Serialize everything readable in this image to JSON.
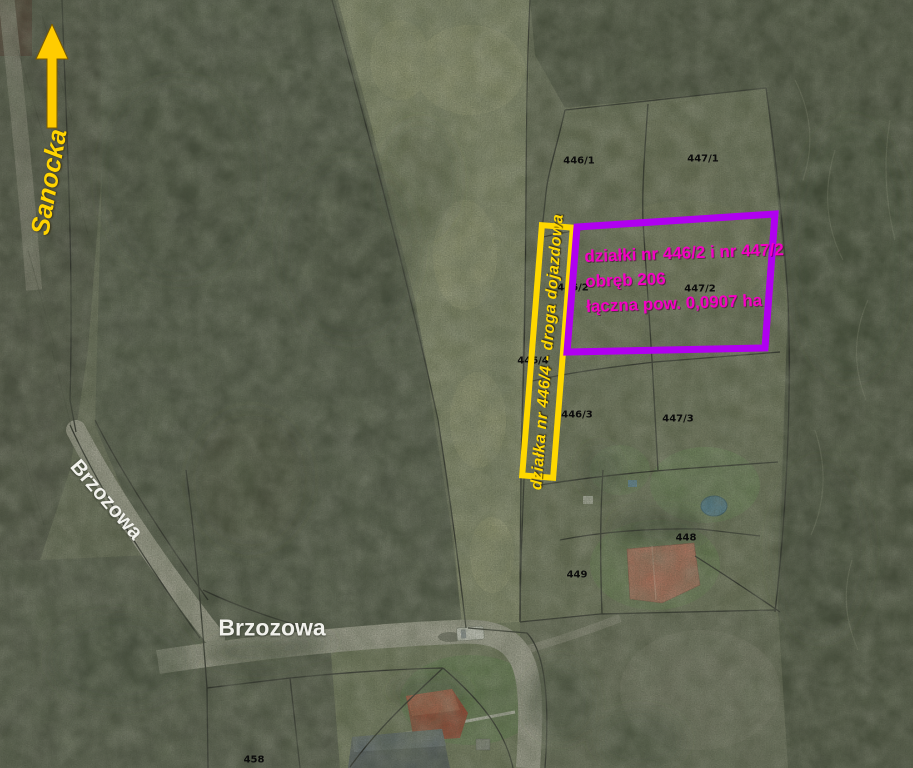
{
  "map": {
    "streets": {
      "sanocka": "Sanocka",
      "brzozowa_upper": "Brzozowa",
      "brzozowa_lower": "Brzozowa"
    },
    "annotations": {
      "direction_arrow": {
        "points_to": "Sanocka",
        "color": "#ffcc00"
      },
      "access_road": {
        "label": "działka nr 446/4 - droga dojazdowa",
        "outline_color": "#ffd800"
      },
      "highlighted_parcels": {
        "line1": "działki nr 446/2 i nr 447/2",
        "line2": "obręb 206",
        "line3": "łączna pow. 0,0907 ha",
        "outline_color": "#b000f0",
        "text_color": "#f400c4"
      }
    },
    "parcel_labels": [
      {
        "label": "446/1"
      },
      {
        "label": "447/1"
      },
      {
        "label": "446/2"
      },
      {
        "label": "447/2"
      },
      {
        "label": "446/4"
      },
      {
        "label": "446/3"
      },
      {
        "label": "447/3"
      },
      {
        "label": "448"
      },
      {
        "label": "449"
      },
      {
        "label": "458"
      }
    ]
  }
}
